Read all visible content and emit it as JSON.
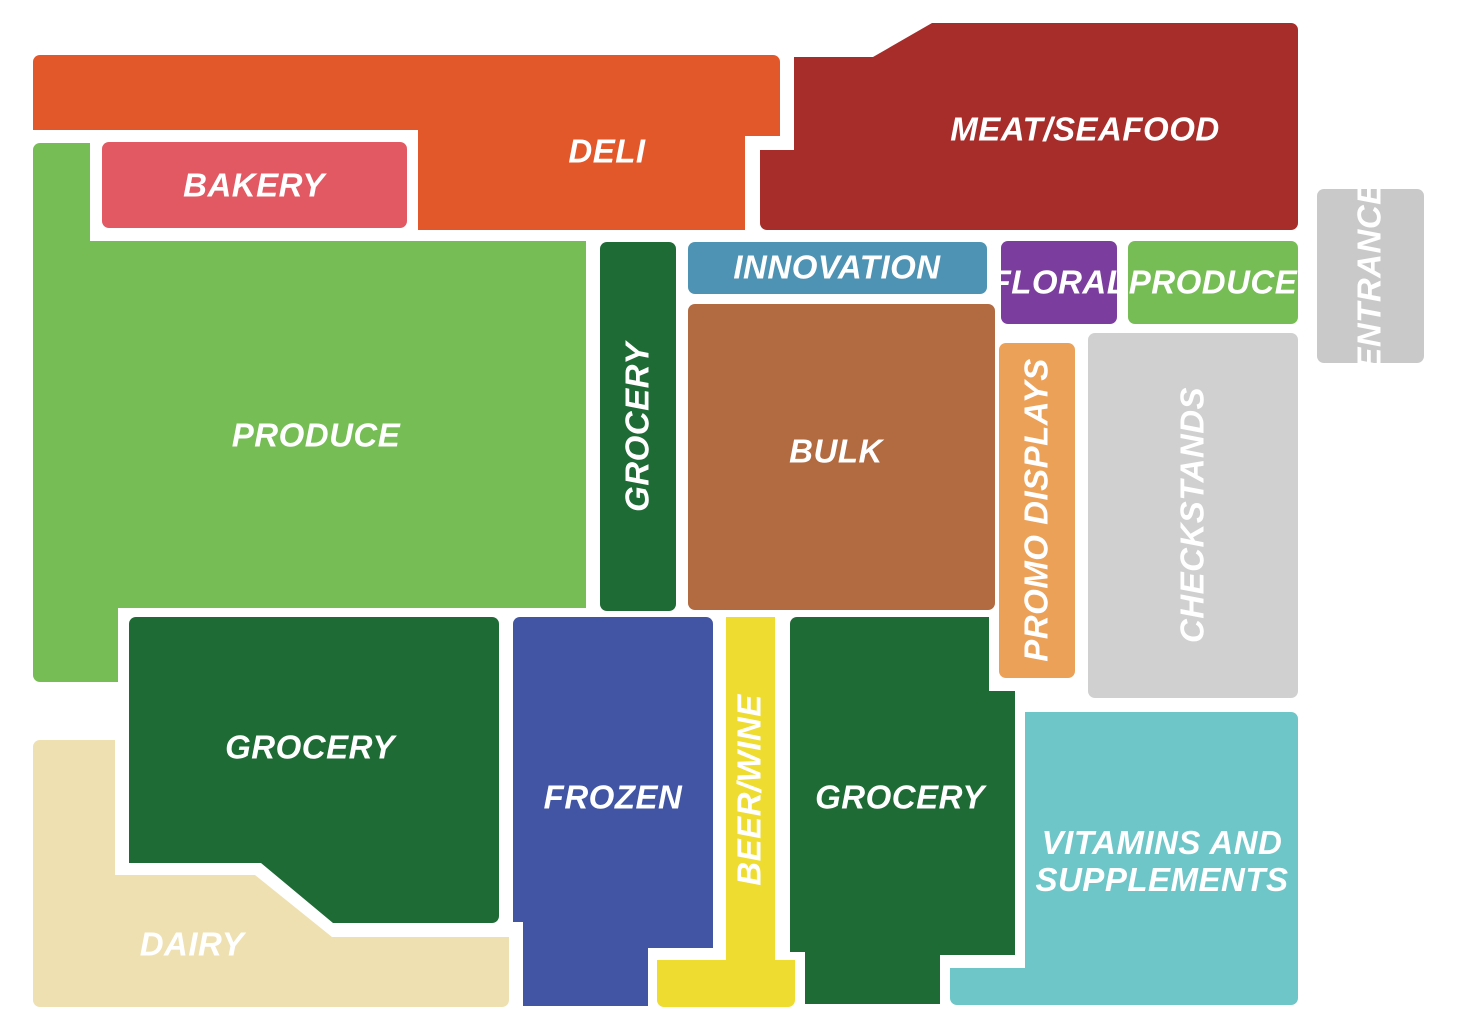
{
  "map": {
    "title": "Store floor plan",
    "background": "#ffffff",
    "label_color": "#ffffff",
    "regions": [
      {
        "id": "deli",
        "label": "DELI",
        "color": "#E2582B"
      },
      {
        "id": "bakery",
        "label": "BAKERY",
        "color": "#E25963"
      },
      {
        "id": "meat-seafood",
        "label": "MEAT/SEAFOOD",
        "color": "#A72D2B"
      },
      {
        "id": "produce-main",
        "label": "PRODUCE",
        "color": "#77BD56"
      },
      {
        "id": "grocery-aisle",
        "label": "GROCERY",
        "color": "#1E6B35",
        "orientation": "vertical"
      },
      {
        "id": "innovation",
        "label": "INNOVATION",
        "color": "#4E93B4"
      },
      {
        "id": "floral",
        "label": "FLORAL",
        "color": "#7B3E9E"
      },
      {
        "id": "produce-entry",
        "label": "PRODUCE",
        "color": "#77BD56"
      },
      {
        "id": "bulk",
        "label": "BULK",
        "color": "#B26A41"
      },
      {
        "id": "promo-displays",
        "label": "PROMO DISPLAYS",
        "color": "#ECA159",
        "orientation": "vertical"
      },
      {
        "id": "checkstands",
        "label": "CHECKSTANDS",
        "color": "#D0D0D0",
        "orientation": "vertical"
      },
      {
        "id": "entrance",
        "label": "ENTRANCE",
        "color": "#C9C9C9",
        "orientation": "vertical"
      },
      {
        "id": "grocery-left",
        "label": "GROCERY",
        "color": "#1E6B35"
      },
      {
        "id": "frozen",
        "label": "FROZEN",
        "color": "#4155A4"
      },
      {
        "id": "beer-wine",
        "label": "BEER/WINE",
        "color": "#EEDC30",
        "orientation": "vertical"
      },
      {
        "id": "grocery-right",
        "label": "GROCERY",
        "color": "#1E6B35"
      },
      {
        "id": "vitamins",
        "label": "VITAMINS AND SUPPLEMENTS",
        "color": "#6EC6C8"
      },
      {
        "id": "dairy",
        "label": "DAIRY",
        "color": "#EFE0B1"
      }
    ]
  }
}
